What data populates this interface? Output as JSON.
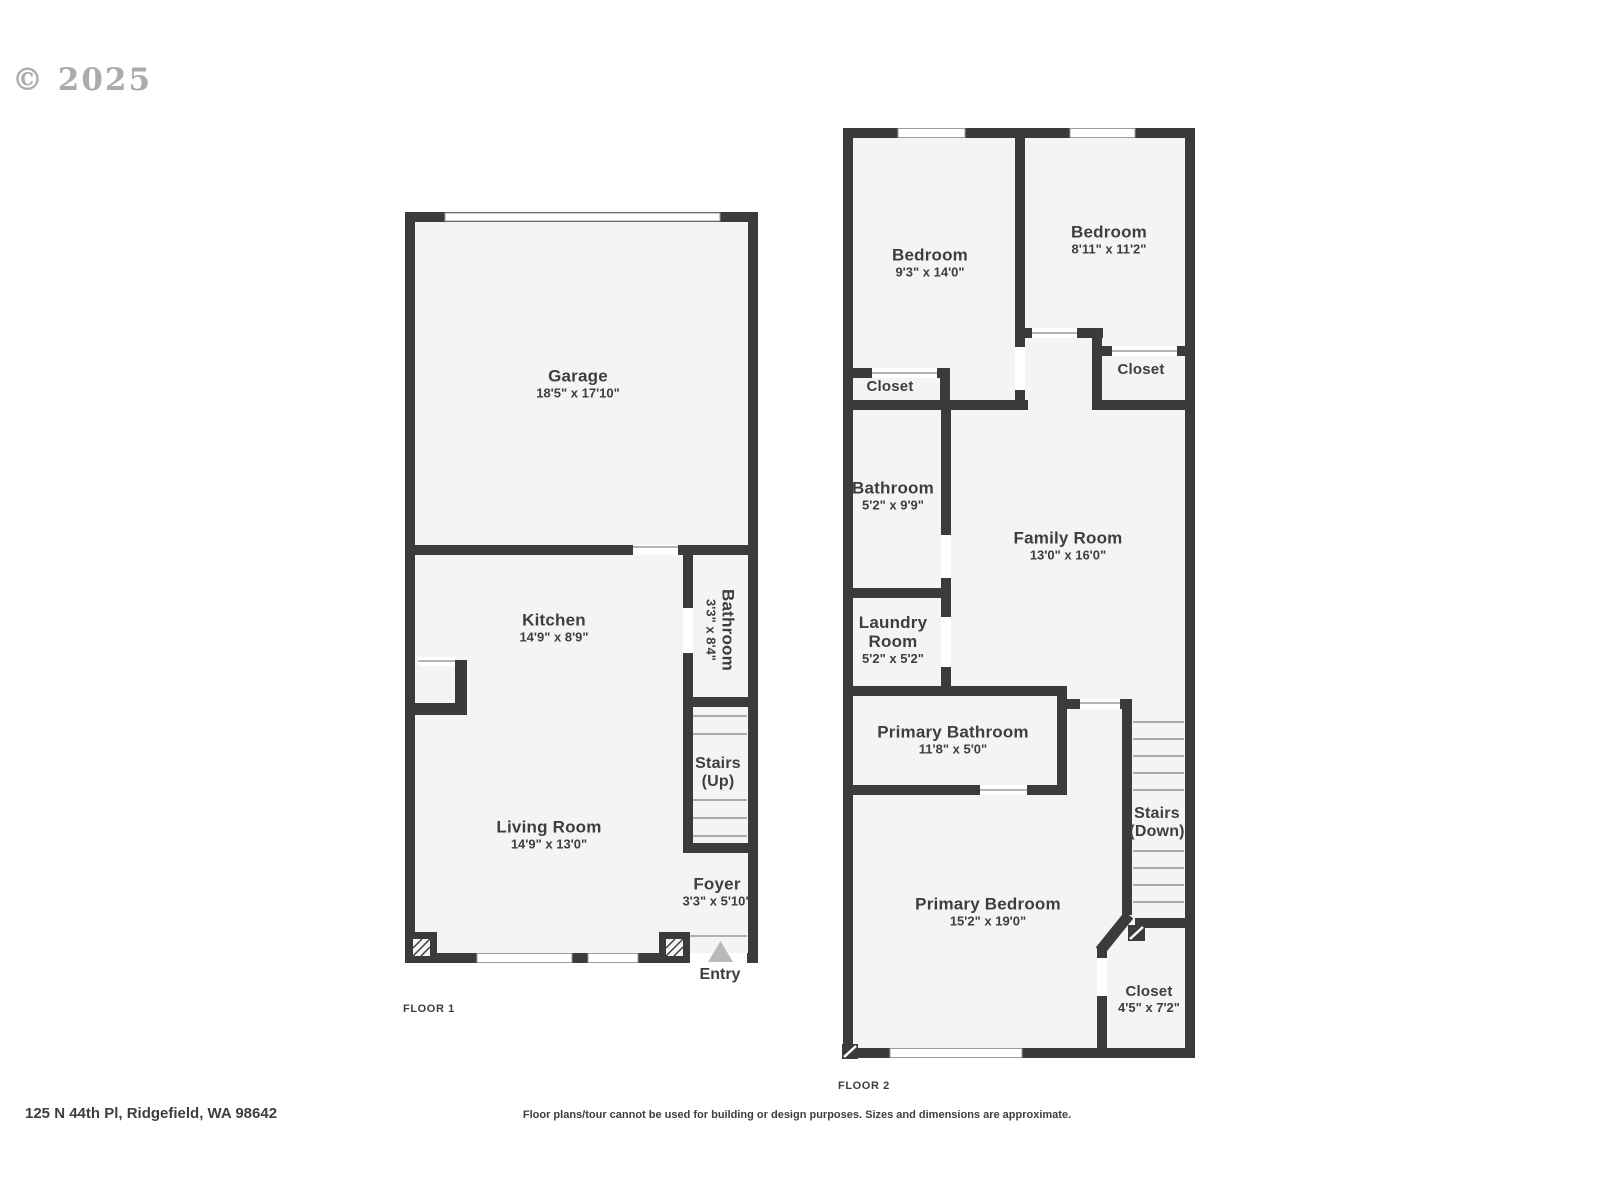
{
  "watermark": "© 2025",
  "floor1": {
    "label": "FLOOR 1",
    "rooms": {
      "garage": {
        "name": "Garage",
        "dims": "18'5\" x 17'10\""
      },
      "kitchen": {
        "name": "Kitchen",
        "dims": "14'9\" x 8'9\""
      },
      "bathroom": {
        "name": "Bathroom",
        "dims": "3'3\" x 8'4\""
      },
      "stairs": {
        "name": "Stairs",
        "direction": "(Up)"
      },
      "living_room": {
        "name": "Living Room",
        "dims": "14'9\" x 13'0\""
      },
      "foyer": {
        "name": "Foyer",
        "dims": "3'3\" x 5'10\""
      },
      "entry": {
        "name": "Entry"
      }
    }
  },
  "floor2": {
    "label": "FLOOR 2",
    "rooms": {
      "bedroom1": {
        "name": "Bedroom",
        "dims": "9'3\" x 14'0\""
      },
      "bedroom2": {
        "name": "Bedroom",
        "dims": "8'11\" x 11'2\""
      },
      "closet1": {
        "name": "Closet"
      },
      "closet2": {
        "name": "Closet"
      },
      "bathroom": {
        "name": "Bathroom",
        "dims": "5'2\" x 9'9\""
      },
      "family_room": {
        "name": "Family Room",
        "dims": "13'0\" x 16'0\""
      },
      "laundry_room": {
        "name": "Laundry Room",
        "dims": "5'2\" x 5'2\""
      },
      "primary_bathroom": {
        "name": "Primary Bathroom",
        "dims": "11'8\" x 5'0\""
      },
      "stairs": {
        "name": "Stairs",
        "direction": "(Down)"
      },
      "primary_bedroom": {
        "name": "Primary Bedroom",
        "dims": "15'2\" x 19'0\""
      },
      "primary_closet": {
        "name": "Closet",
        "dims": "4'5\" x 7'2\""
      }
    }
  },
  "footer": {
    "address": "125 N 44th Pl, Ridgefield, WA 98642",
    "disclaimer": "Floor plans/tour cannot be used for building or design purposes. Sizes and dimensions are approximate."
  },
  "colors": {
    "wall": "#3b3b3d",
    "room_fill": "#f4f4f3",
    "thin_line": "#9b9b9b",
    "stair_tread": "#ababab",
    "label_text": "#3e3e40",
    "entry_arrow": "#b9b9b9",
    "watermark_gray": "#9d9d9d"
  }
}
